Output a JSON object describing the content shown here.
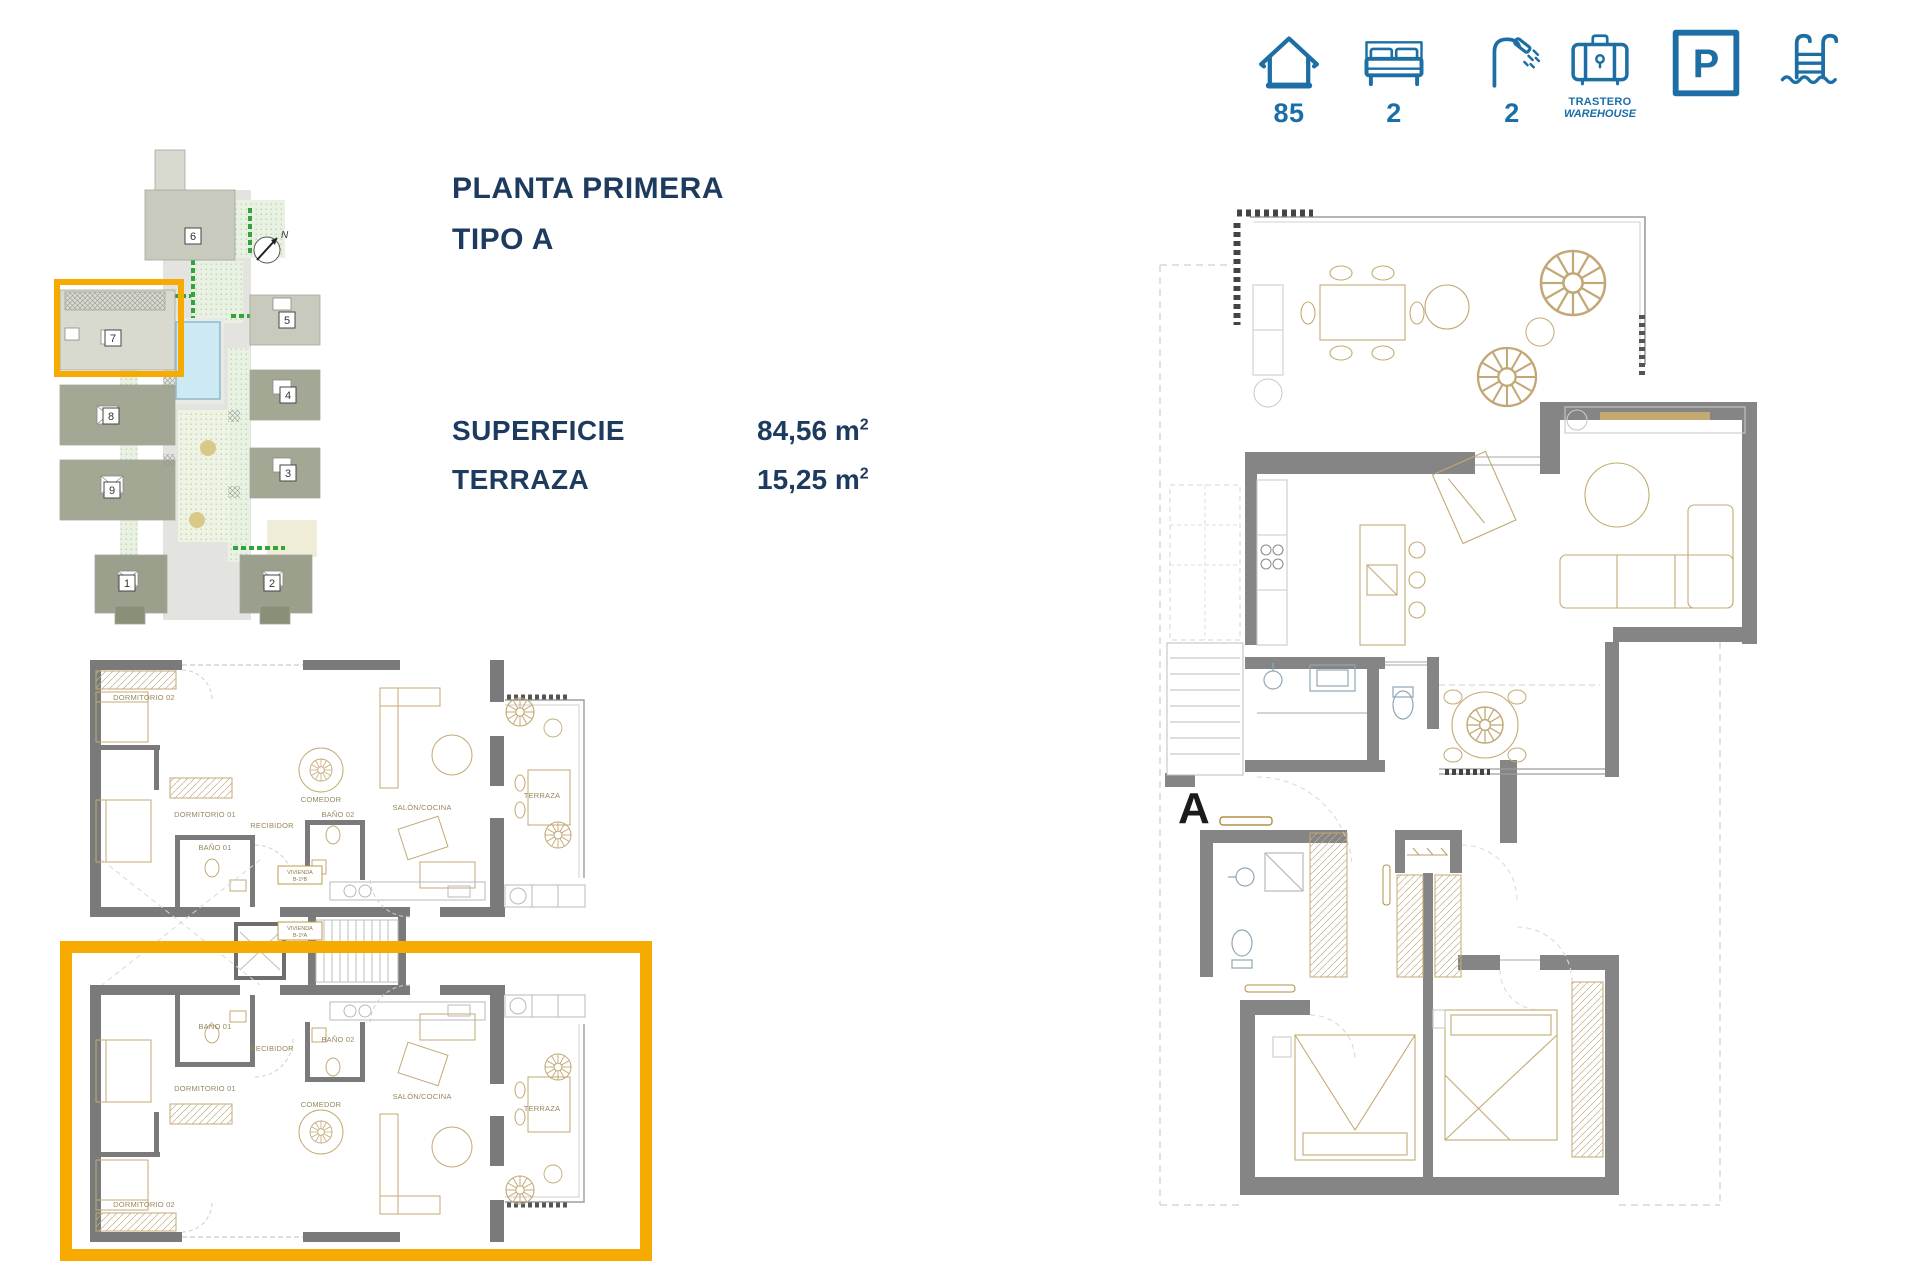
{
  "colors": {
    "icon_blue": "#1c6ea4",
    "navy": "#1d3a5f",
    "highlight_yellow": "#f7ab00",
    "wall_gray": "#828282",
    "furniture_tan": "#c3aa74"
  },
  "header": {
    "features": [
      {
        "icon": "house-icon",
        "value": "85"
      },
      {
        "icon": "bed-icon",
        "value": "2"
      },
      {
        "icon": "shower-icon",
        "value": "2"
      },
      {
        "icon": "warehouse-icon",
        "label_line1": "TRASTERO",
        "label_line2": "WAREHOUSE"
      },
      {
        "icon": "parking-icon",
        "letter": "P"
      },
      {
        "icon": "pool-icon"
      }
    ]
  },
  "title": {
    "line1": "PLANTA PRIMERA",
    "line2": "TIPO A"
  },
  "specs": [
    {
      "label": "SUPERFICIE",
      "value": "84,56",
      "unit_base": "m",
      "unit_sup": "2"
    },
    {
      "label": "TERRAZA",
      "value": "15,25",
      "unit_base": "m",
      "unit_sup": "2"
    }
  ],
  "site_plan": {
    "compass_label": "N",
    "building_numbers": [
      "1",
      "2",
      "3",
      "4",
      "5",
      "6",
      "7",
      "8",
      "9"
    ],
    "highlighted_building": "7"
  },
  "floor_plan_small": {
    "unit_top_labels": {
      "dormitorio_02": "DORMITORIO 02",
      "dormitorio_01": "DORMITORIO 01",
      "bano_01": "BAÑO 01",
      "bano_02": "BAÑO 02",
      "recibidor": "RECIBIDOR",
      "comedor": "COMEDOR",
      "salon_cocina": "SALÓN/COCINA",
      "terraza": "TERRAZA"
    },
    "unit_bottom_labels": {
      "dormitorio_02": "DORMITORIO 02",
      "dormitorio_01": "DORMITORIO 01",
      "bano_01": "BAÑO 01",
      "bano_02": "BAÑO 02",
      "recibidor": "RECIBIDOR",
      "comedor": "COMEDOR",
      "salon_cocina": "SALÓN/COCINA",
      "terraza": "TERRAZA"
    },
    "unit_tags": [
      {
        "line1": "VIVIENDA",
        "line2": "B-1ºB"
      },
      {
        "line1": "VIVIENDA",
        "line2": "B-1ºA"
      }
    ]
  },
  "floor_plan_large": {
    "unit_label": "A"
  }
}
